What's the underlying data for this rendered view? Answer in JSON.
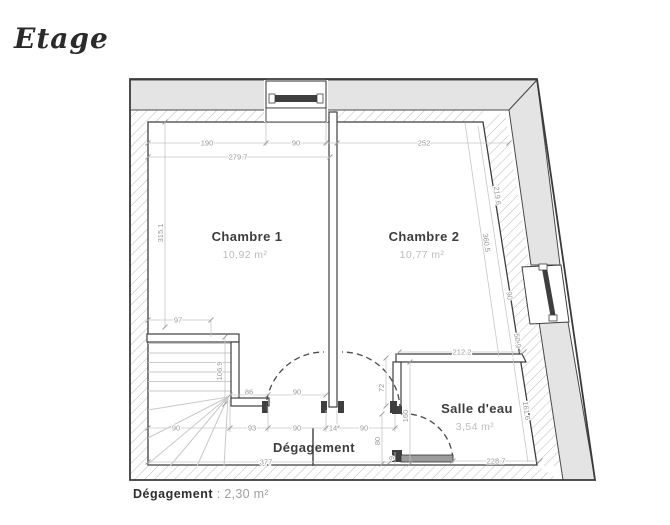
{
  "title": "Etage",
  "note": {
    "label": "Dégagement",
    "rest": " : 2,30 m²"
  },
  "rooms": {
    "chambre1": {
      "name": "Chambre 1",
      "area": "10,92 m²"
    },
    "chambre2": {
      "name": "Chambre 2",
      "area": "10,77 m²"
    },
    "salle_eau": {
      "name": "Salle d'eau",
      "area": "3,54 m²"
    },
    "degagement": {
      "name": "Dégagement"
    }
  },
  "dims": {
    "top_190": "190",
    "top_win_90": "90",
    "top_252": "252",
    "top_279_7": "279.7",
    "left_315_1": "315.1",
    "left_97": "97",
    "slant_219_6": "219.6",
    "slant_360_5": "360.5",
    "slant_win_90": "90",
    "slant_50_9": "50.9",
    "slant_161_6": "161.6",
    "stair_106_9": "106.9",
    "stair_86": "86",
    "door_left_90": "90",
    "row_stairs_90": "90",
    "row_93": "93",
    "row_door_90": "90",
    "row_wall_14": "14",
    "row_door2_90": "90",
    "mid_72": "72",
    "sde_160": "160",
    "sde_80": "80",
    "sde_9": "9",
    "sde_212_2": "212.2",
    "bottom_377": "377",
    "bottom_228_7": "228.7"
  },
  "colors": {
    "wall_fill": "#e4e4e4",
    "wall_stroke": "#3f3f3f",
    "dim_text": "#999999",
    "room_label": "#3d3d3d",
    "area_label": "#bcbcbc"
  }
}
